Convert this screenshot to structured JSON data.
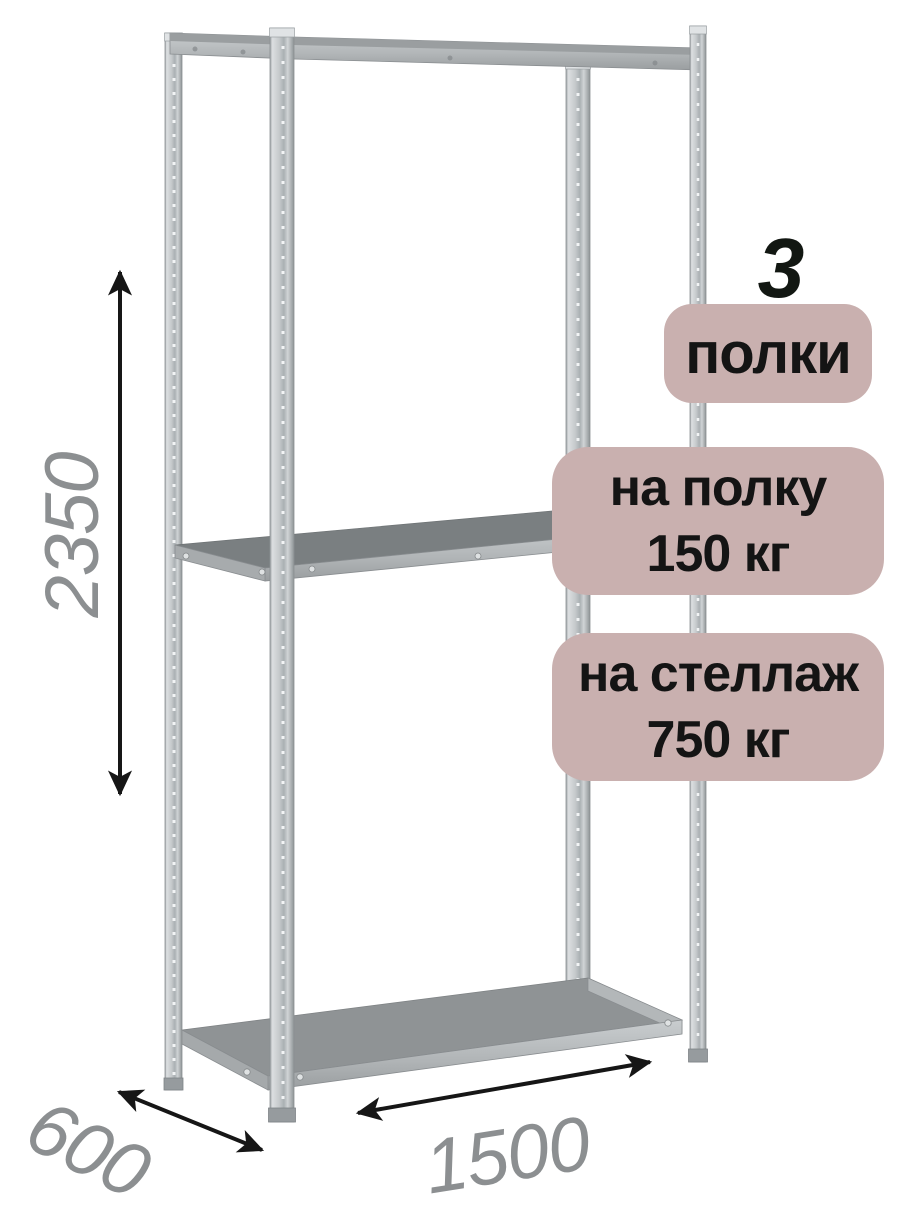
{
  "rack": {
    "shelf_count": "3",
    "shelf_count_label": "полки",
    "per_shelf_load": {
      "line1": "на полку",
      "line2": "150 кг"
    },
    "per_rack_load": {
      "line1": "на стеллаж",
      "line2": "750 кг"
    },
    "dimensions": {
      "height_mm": "2350",
      "depth_mm": "600",
      "width_mm": "1500"
    }
  },
  "icons": {
    "height_arrow": "vertical-double-arrow",
    "depth_arrow": "diagonal-double-arrow",
    "width_arrow": "diagonal-double-arrow"
  },
  "colors": {
    "badge_background": "#c9b0af",
    "badge_text": "#141414",
    "dimension_text": "#8c8f91",
    "arrow": "#161616",
    "metal_light": "#d9dcde",
    "metal_mid": "#b5b9bb",
    "metal_dark": "#8f9496",
    "shelf_top_bottom_shelf": "#8f9395",
    "shelf_top_middle_shelf": "#7a7f81"
  }
}
